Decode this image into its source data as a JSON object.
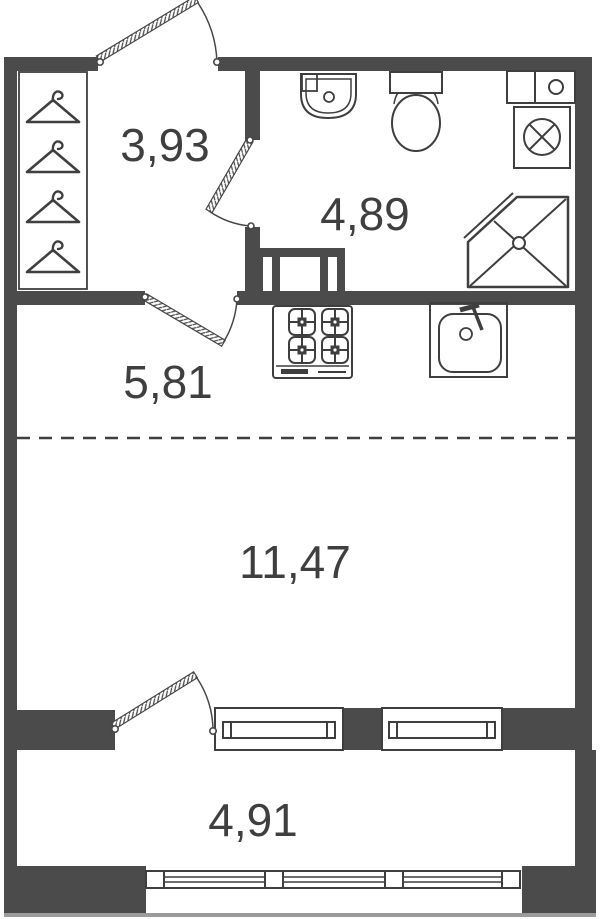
{
  "colors": {
    "wall": "#4b4b4b",
    "line": "#3f3f3f",
    "label": "#3f3f3f",
    "background": "#ffffff",
    "outer_edge": "#9b9b9b"
  },
  "rooms": {
    "wardrobe": {
      "area": "3,93"
    },
    "bathroom": {
      "area": "4,89"
    },
    "kitchen_hall": {
      "area": "5,81"
    },
    "living_room": {
      "area": "11,47"
    },
    "balcony": {
      "area": "4,91"
    }
  },
  "fixtures": [
    {
      "icon": "hanger-icon",
      "count": 4,
      "room": "wardrobe"
    },
    {
      "icon": "wash-basin-icon",
      "room": "bathroom"
    },
    {
      "icon": "toilet-icon",
      "room": "bathroom"
    },
    {
      "icon": "water-heater-icon",
      "room": "bathroom"
    },
    {
      "icon": "washing-machine-icon",
      "room": "bathroom"
    },
    {
      "icon": "corner-shower-icon",
      "room": "bathroom"
    },
    {
      "icon": "transom-window-icon",
      "room": "bathroom"
    },
    {
      "icon": "gas-stove-icon",
      "room": "kitchen_hall"
    },
    {
      "icon": "kitchen-sink-icon",
      "room": "kitchen_hall"
    },
    {
      "icon": "entrance-door-icon",
      "room": "wardrobe"
    },
    {
      "icon": "interior-door-icon",
      "count": 2
    },
    {
      "icon": "balcony-door-icon",
      "room": "living_room"
    },
    {
      "icon": "window-icon",
      "count": 2,
      "room": "living_room"
    },
    {
      "icon": "balcony-glazing-icon",
      "room": "balcony"
    },
    {
      "icon": "zone-divider-dashed-line",
      "room": "kitchen_hall"
    }
  ]
}
